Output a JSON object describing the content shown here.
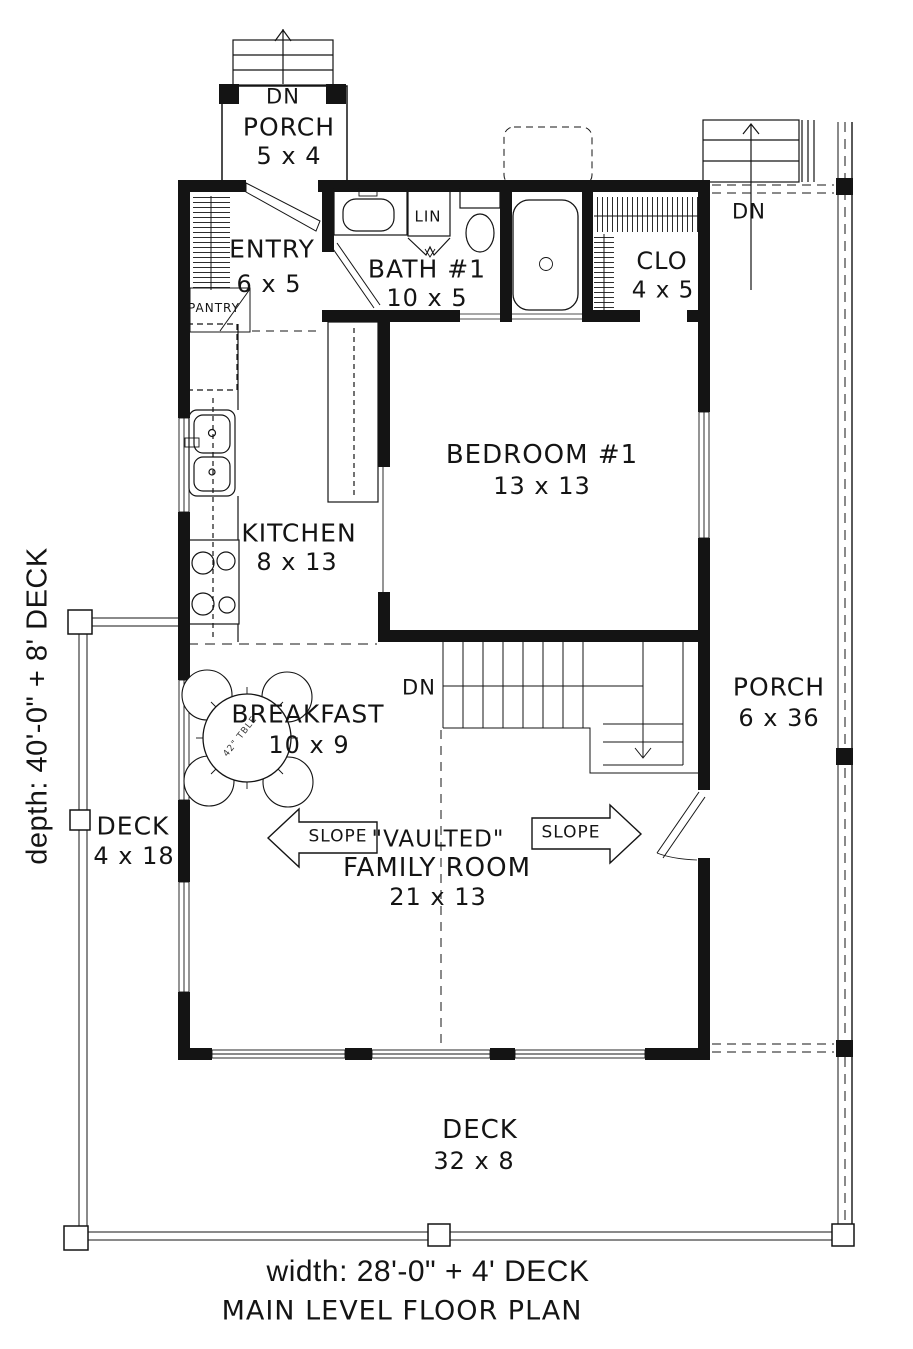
{
  "plan": {
    "title": "MAIN LEVEL FLOOR PLAN",
    "width_note": "width: 28'-0\" + 4' DECK",
    "depth_note": "depth: 40'-0\" + 8' DECK"
  },
  "rooms": {
    "porch_top": {
      "name": "PORCH",
      "dims": "5 x 4"
    },
    "entry": {
      "name": "ENTRY",
      "dims": "6 x 5"
    },
    "pantry": {
      "name": "PANTRY"
    },
    "bath_1": {
      "name": "BATH #1",
      "dims": "10 x 5"
    },
    "linen": {
      "name": "LIN"
    },
    "closet": {
      "name": "CLO",
      "dims": "4 x 5"
    },
    "bedroom_1": {
      "name": "BEDROOM #1",
      "dims": "13 x 13"
    },
    "kitchen": {
      "name": "KITCHEN",
      "dims": "8 x 13"
    },
    "breakfast": {
      "name": "BREAKFAST",
      "dims": "10 x 9"
    },
    "family_room": {
      "qualifier": "\"VAULTED\"",
      "name": "FAMILY ROOM",
      "dims": "21 x 13"
    },
    "porch_side": {
      "name": "PORCH",
      "dims": "6 x 36"
    },
    "deck_side": {
      "name": "DECK",
      "dims": "4 x 18"
    },
    "deck_bottom": {
      "name": "DECK",
      "dims": "32 x 8"
    }
  },
  "annotations": {
    "down_top_porch": "DN",
    "down_side_porch": "DN",
    "down_stairs": "DN",
    "slope_left": "SLOPE",
    "slope_right": "SLOPE",
    "table_note": "42\" TBLE"
  },
  "colors": {
    "ink": "#141414",
    "paper": "#ffffff"
  }
}
